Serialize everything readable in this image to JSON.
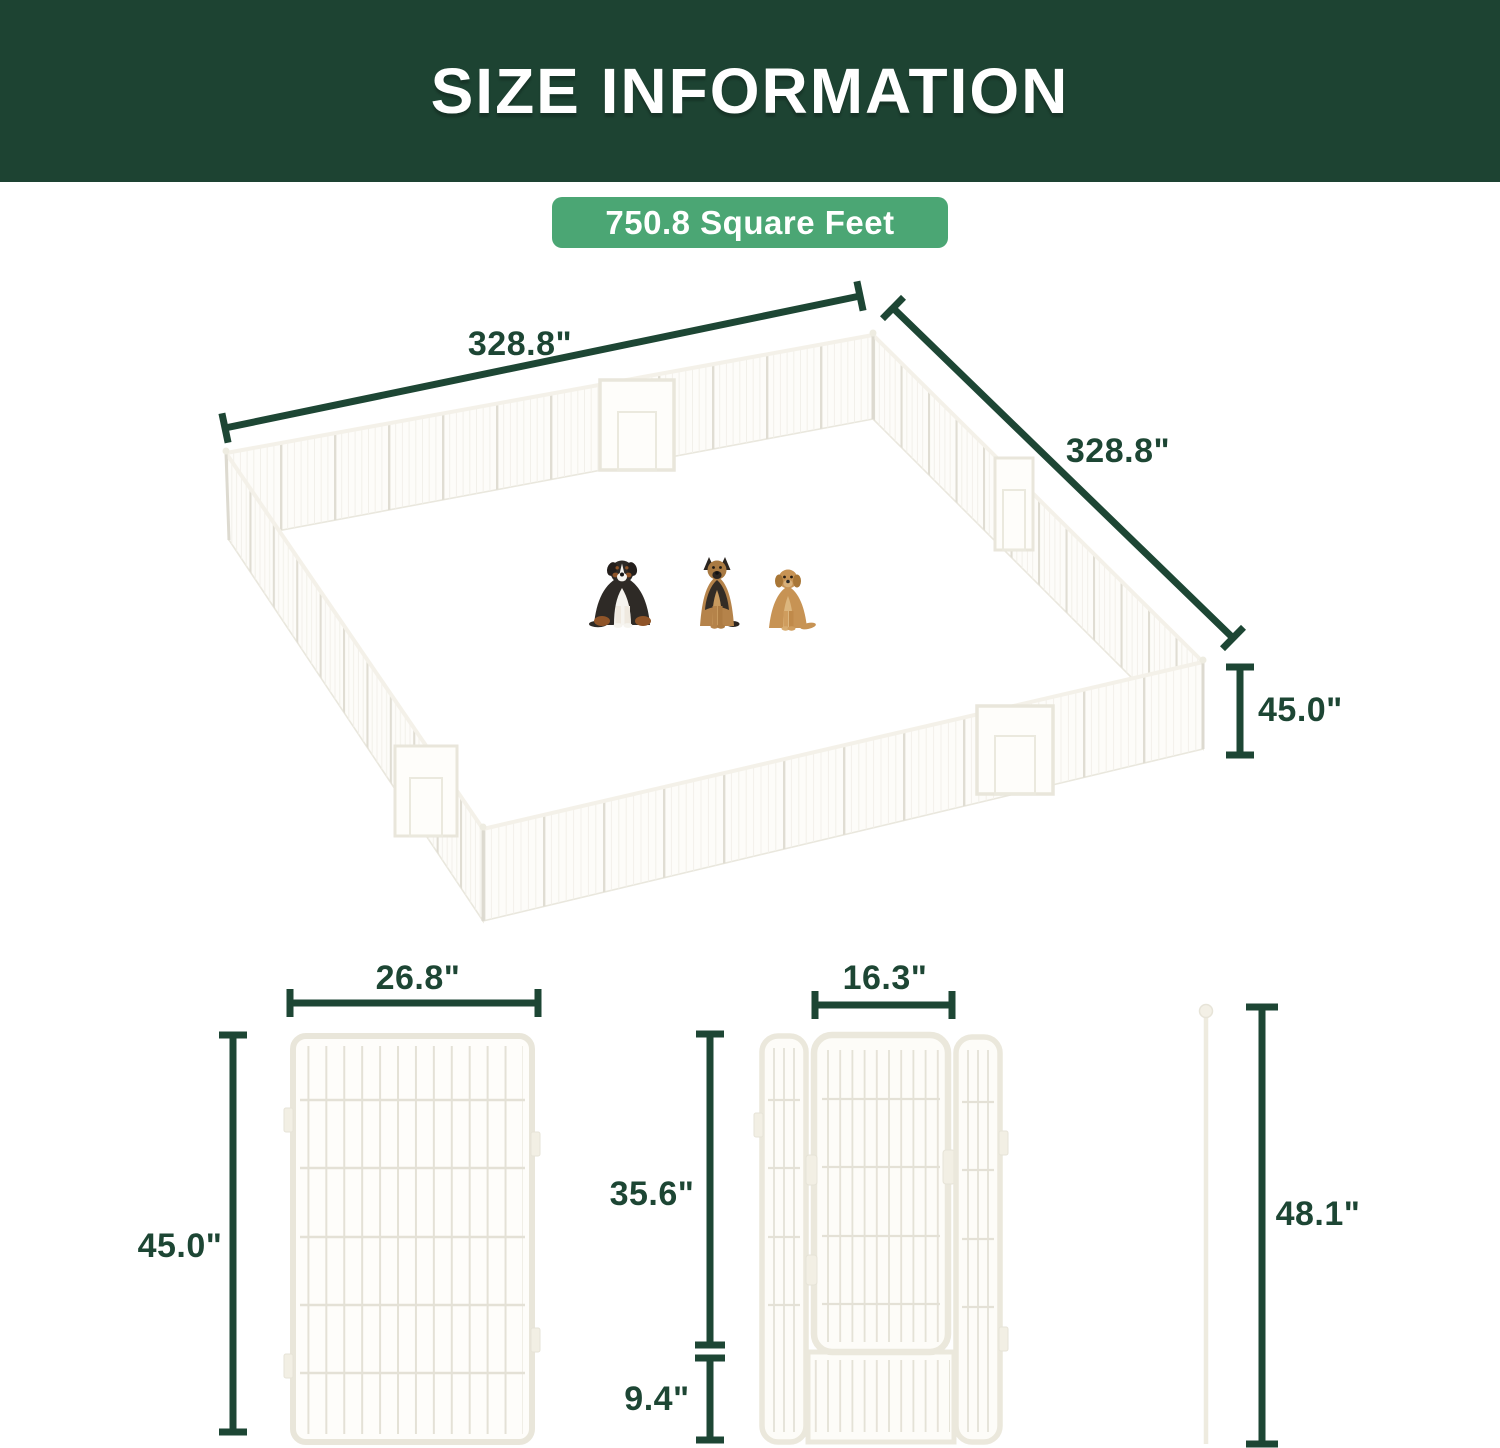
{
  "header": {
    "title": "SIZE INFORMATION"
  },
  "badge": {
    "label": "750.8 Square Feet"
  },
  "colors": {
    "header_bg": "#1d4332",
    "badge_bg": "#4ba674",
    "dimension_green": "#1d4634",
    "fence_cream": "#e9e6dc",
    "background": "#ffffff"
  },
  "main_diagram": {
    "top_width": "328.8\"",
    "side_depth": "328.8\"",
    "fence_height": "45.0\"",
    "dogs": [
      {
        "icon": "bernese-mountain-dog-icon"
      },
      {
        "icon": "german-shepherd-icon"
      },
      {
        "icon": "golden-retriever-icon"
      }
    ]
  },
  "panel_diagram": {
    "width": "26.8\"",
    "height": "45.0\""
  },
  "gate_diagram": {
    "door_width": "16.3\"",
    "upper_height": "35.6\"",
    "bottom_height": "9.4\""
  },
  "pole_diagram": {
    "height": "48.1\""
  }
}
